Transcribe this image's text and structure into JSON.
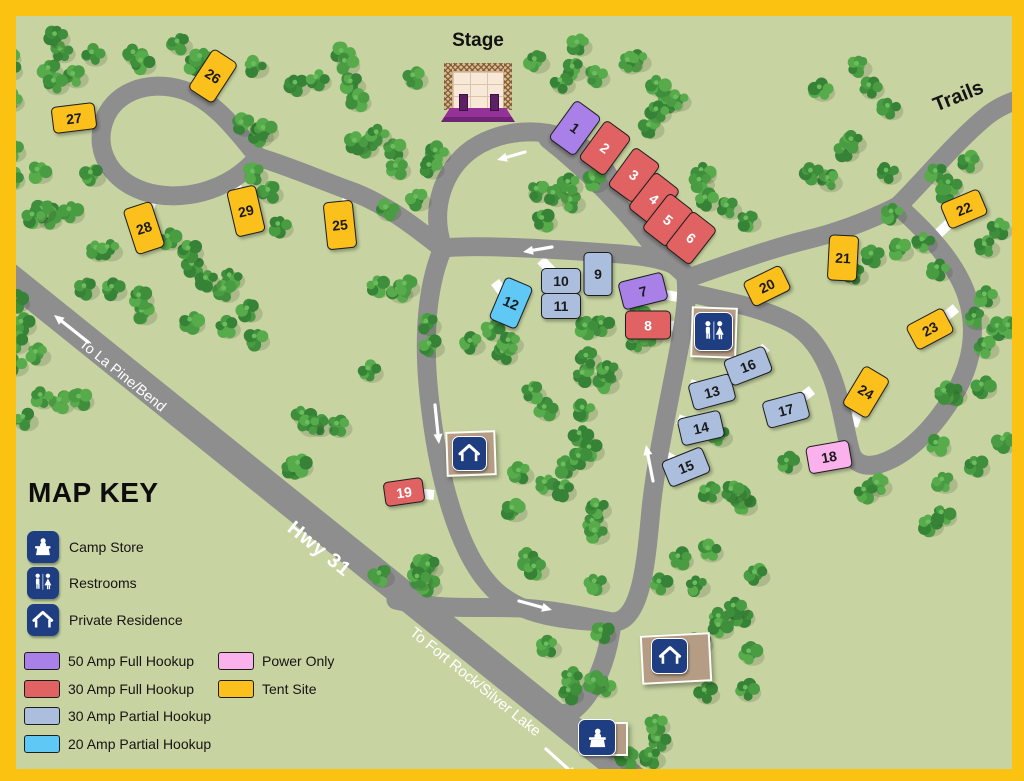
{
  "map_labels": {
    "stage": "Stage",
    "trails": "Trails",
    "hwy": "Hwy 31",
    "to_la_pine": "To La Pine/Bend",
    "to_fort_rock": "To Fort Rock/Silver Lake"
  },
  "map_key": {
    "title": "MAP KEY",
    "facilities": [
      {
        "icon": "camp-store-icon",
        "label": "Camp Store"
      },
      {
        "icon": "restrooms-icon",
        "label": "Restrooms"
      },
      {
        "icon": "private-residence-icon",
        "label": "Private Residence"
      }
    ],
    "site_types": [
      {
        "id": "50-amp-full",
        "label": "50 Amp Full Hookup",
        "color": "#a97fe8",
        "text_color": "#1a1a1a"
      },
      {
        "id": "30-amp-full",
        "label": "30 Amp Full Hookup",
        "color": "#e06262",
        "text_color": "#ffffff"
      },
      {
        "id": "30-amp-partial",
        "label": "30 Amp Partial Hookup",
        "color": "#abbedd",
        "text_color": "#1a1a1a"
      },
      {
        "id": "20-amp-partial",
        "label": "20 Amp Partial Hookup",
        "color": "#5fc8f5",
        "text_color": "#1a1a1a"
      },
      {
        "id": "power-only",
        "label": "Power Only",
        "color": "#fbb1ec",
        "text_color": "#1a1a1a"
      },
      {
        "id": "tent",
        "label": "Tent Site",
        "color": "#fcc01d",
        "text_color": "#1a1a1a"
      }
    ]
  },
  "sites": [
    {
      "num": "1",
      "type": "50-amp-full"
    },
    {
      "num": "2",
      "type": "30-amp-full"
    },
    {
      "num": "3",
      "type": "30-amp-full"
    },
    {
      "num": "4",
      "type": "30-amp-full"
    },
    {
      "num": "5",
      "type": "30-amp-full"
    },
    {
      "num": "6",
      "type": "30-amp-full"
    },
    {
      "num": "7",
      "type": "50-amp-full"
    },
    {
      "num": "8",
      "type": "30-amp-full"
    },
    {
      "num": "9",
      "type": "30-amp-partial"
    },
    {
      "num": "10",
      "type": "30-amp-partial"
    },
    {
      "num": "11",
      "type": "30-amp-partial"
    },
    {
      "num": "12",
      "type": "20-amp-partial"
    },
    {
      "num": "13",
      "type": "30-amp-partial"
    },
    {
      "num": "14",
      "type": "30-amp-partial"
    },
    {
      "num": "15",
      "type": "30-amp-partial"
    },
    {
      "num": "16",
      "type": "30-amp-partial"
    },
    {
      "num": "17",
      "type": "30-amp-partial"
    },
    {
      "num": "18",
      "type": "power-only"
    },
    {
      "num": "19",
      "type": "30-amp-full"
    },
    {
      "num": "20",
      "type": "tent"
    },
    {
      "num": "21",
      "type": "tent"
    },
    {
      "num": "22",
      "type": "tent"
    },
    {
      "num": "23",
      "type": "tent"
    },
    {
      "num": "24",
      "type": "tent"
    },
    {
      "num": "25",
      "type": "tent"
    },
    {
      "num": "26",
      "type": "tent"
    },
    {
      "num": "27",
      "type": "tent"
    },
    {
      "num": "28",
      "type": "tent"
    },
    {
      "num": "29",
      "type": "tent"
    }
  ],
  "colors": {
    "frame": "#fcc212",
    "ground": "#c7d4a1",
    "road": "#8e8e8e",
    "driveway": "#ffffff",
    "navy": "#1f3e82",
    "building_tan": "#b49c85",
    "stage_purple": "#8e2f90"
  }
}
